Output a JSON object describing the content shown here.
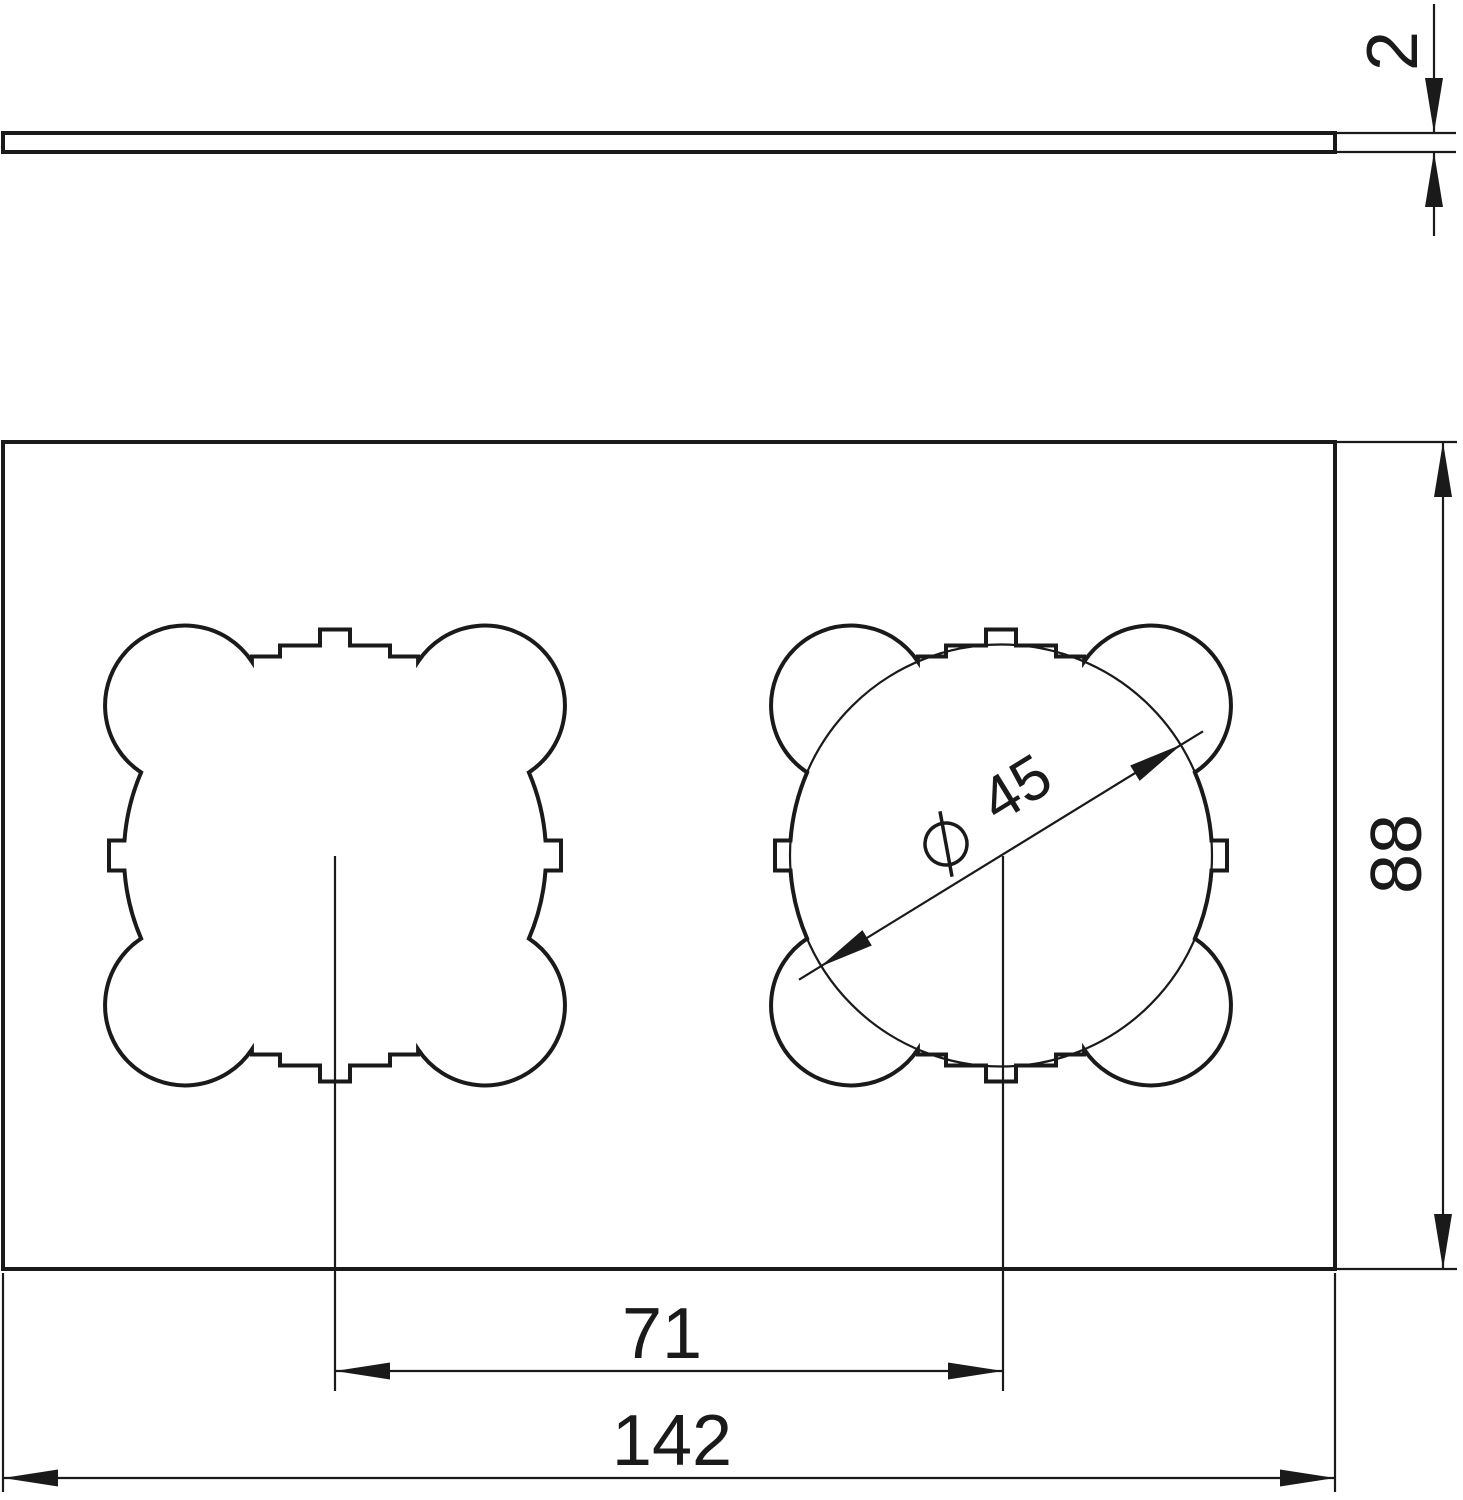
{
  "colors": {
    "line": "#1a1a1a",
    "background": "#ffffff"
  },
  "dimensions": {
    "thickness": {
      "value": "2"
    },
    "plate_height": {
      "value": "88"
    },
    "cutout_spacing": {
      "value": "71"
    },
    "plate_width": {
      "value": "142"
    },
    "cutout_diameter": {
      "value": "45",
      "symbol": "⌀"
    }
  }
}
